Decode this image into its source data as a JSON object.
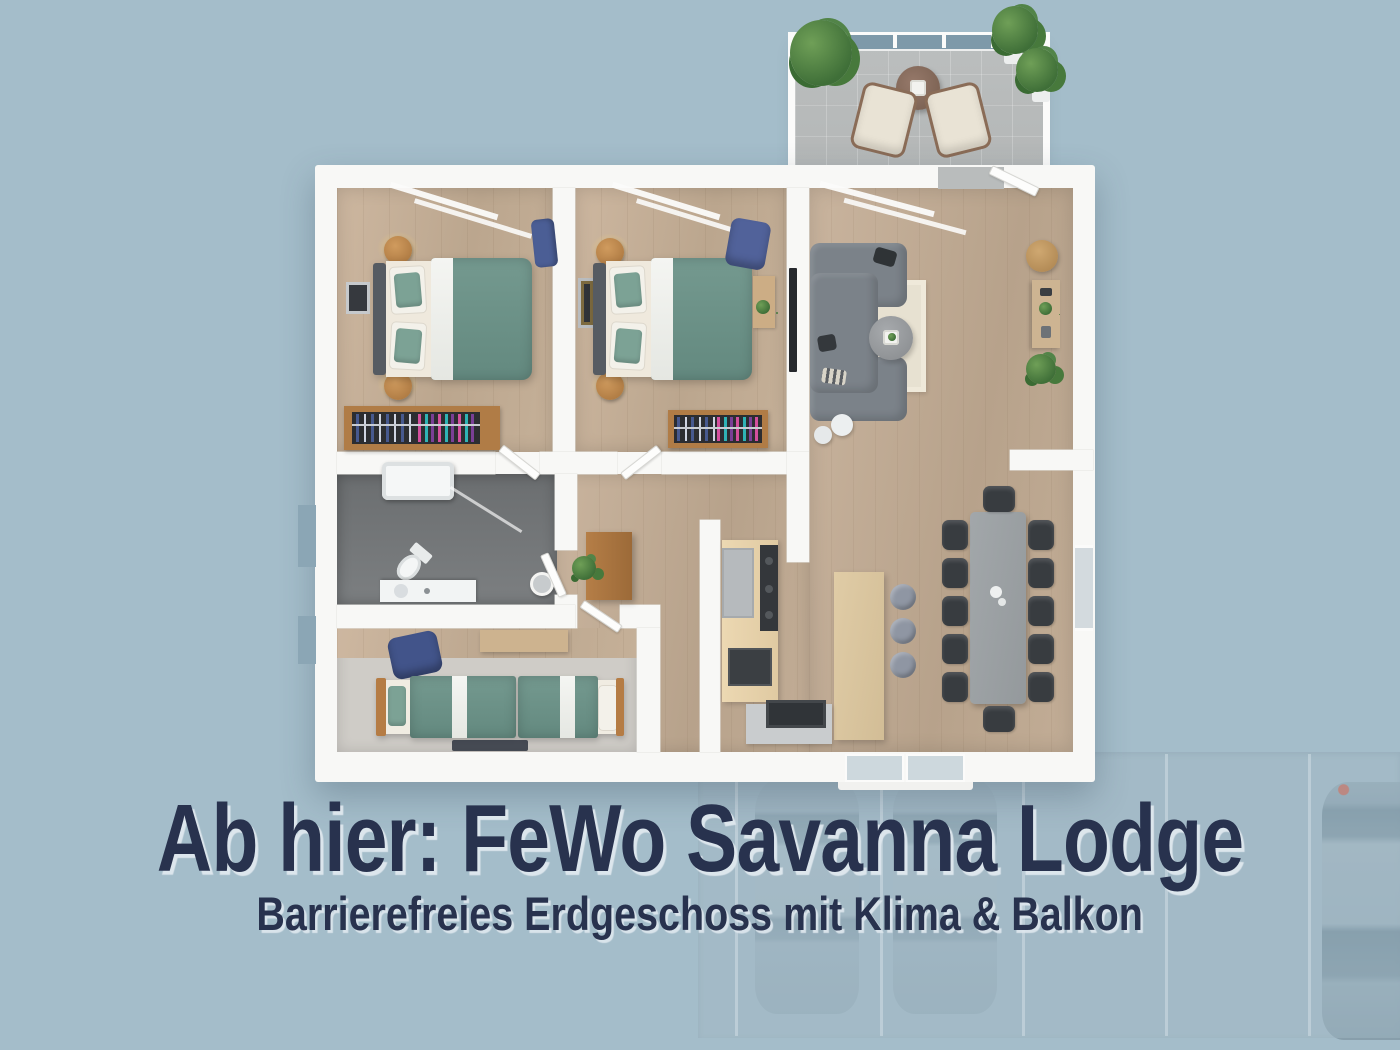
{
  "title": {
    "text": "Ab hier: FeWo Savanna Lodge"
  },
  "subtitle": {
    "text": "Barrierefreies Erdgeschoss mit Klima & Balkon"
  },
  "palette": {
    "background": "#a4bdca",
    "title_text": "#28324e",
    "title_shadow": "#dfe8ee",
    "wall": "#f8f8f6",
    "wood_floor": "#c5b098",
    "bathroom_floor": "#6f7276",
    "bedroom3_floor": "#cfccc7",
    "balcony_floor": "#b9bcbc",
    "railing_glass": "#7e99a9",
    "bed_duvet_teal": "#6d948a",
    "sofa_gray": "#7b8289",
    "dining_table": "#9ba0a3",
    "dining_chair": "#383c40",
    "island_wood": "#dcc7a1",
    "kitchen_counter": "#e8d4ae",
    "cabinet_wood": "#aa7540",
    "accent_chair_blue": "#4b5e95",
    "plant_green": "#477a3f",
    "rug_cream": "#e7e1d1",
    "parking_surface": "#a0b7c3",
    "car_body": "#8fa5b3"
  },
  "parking": {
    "visible_cars": 3,
    "divider_lines": 5
  }
}
